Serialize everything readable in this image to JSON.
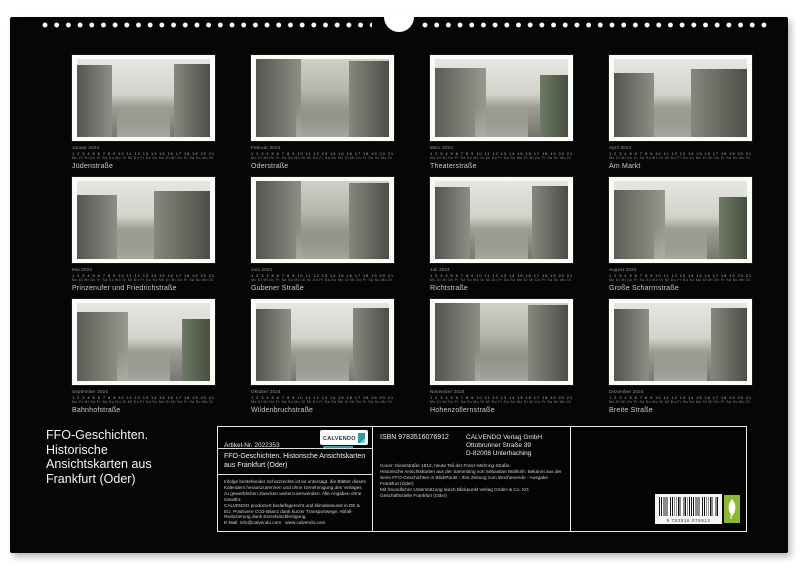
{
  "page": {
    "title_block": "FFO-Geschichten.\nHistorische\nAnsichtskarten aus\nFrankfurt (Oder)"
  },
  "cards": [
    {
      "month": "Januar 2024",
      "caption": "Jüdenstraße"
    },
    {
      "month": "Februar 2024",
      "caption": "Oderstraße"
    },
    {
      "month": "März 2024",
      "caption": "Theaterstraße"
    },
    {
      "month": "April 2024",
      "caption": "Am Markt"
    },
    {
      "month": "Mai 2024",
      "caption": "Prinzenufer und Friedrichstraße"
    },
    {
      "month": "Juni 2024",
      "caption": "Gubener Straße"
    },
    {
      "month": "Juli 2024",
      "caption": "Richtstraße"
    },
    {
      "month": "August 2024",
      "caption": "Große Scharrnstraße"
    },
    {
      "month": "September 2024",
      "caption": "Bahnhofstraße"
    },
    {
      "month": "Oktober 2024",
      "caption": "Wildenbruchstraße"
    },
    {
      "month": "November 2024",
      "caption": "Hohenzollernstraße"
    },
    {
      "month": "Dezember 2024",
      "caption": "Breite Straße"
    }
  ],
  "date_strip": {
    "numbers": "1 2 3 4 5 6 7 8 9 10 11 12 13 14 15 16 17 18 19 20 21 22 23 24 25 26 27 28 29 30 31",
    "days": "Mo Di Mi Do Fr Sa So Mo Di Mi Do Fr Sa So Mo Di Mi Do Fr Sa So Mo Di Mi Do Fr Sa So Mo Di Mi"
  },
  "info": {
    "artikel": "Artikel-Nr. 2022353",
    "logo_text": "CALVENDO",
    "product_title": "FFO-Geschichten. Historische Ansichtskarten aus Frankfurt (Oder)",
    "legal": "Infolge bestehender Schutzrechte ist es untersagt, die Blätter dieses Kalenders herauszutrennen und ohne Genehmigung des Verlages zu gewerblichen Zwecken weiterzuverwenden. Alle Angaben ohne Gewähr.\nCALVENDO produziert bedarfsgerecht und klimabewusst in DE & EU. Positivere CO2-Bilanz dank kurzer Transportwege. Abfall-Reduzierung dank Einzelstückfertigung.\nE-Mail: info@calvendo.com · www.calvendo.com",
    "isbn": "ISBN 9783516076912",
    "publisher": "CALVENDO Verlag GmbH\nOttobrunner Straße 39\nD-82008 Unterhaching",
    "credits": "Cover: Kleiststraße 1912, heute Teil der Franz-Mehring-Straße\nHistorische Ansichtskarten aus der Sammlung von Sebastian Wallroth. Bekannt aus der Serie FFO-Geschichten in BlickPunkt - Ihre Zeitung zum Wochenende - Ausgabe Frankfurt (Oder)\nMit freundlicher Unterstützung durch Blickpunkt Verlag GmbH & Co. KG\nGeschäftsstelle Frankfurt (Oder)",
    "barcode_number": "9 783516 076912"
  },
  "colors": {
    "accent_teal": "#2e9aa6",
    "eco_green": "#8cb82b"
  }
}
